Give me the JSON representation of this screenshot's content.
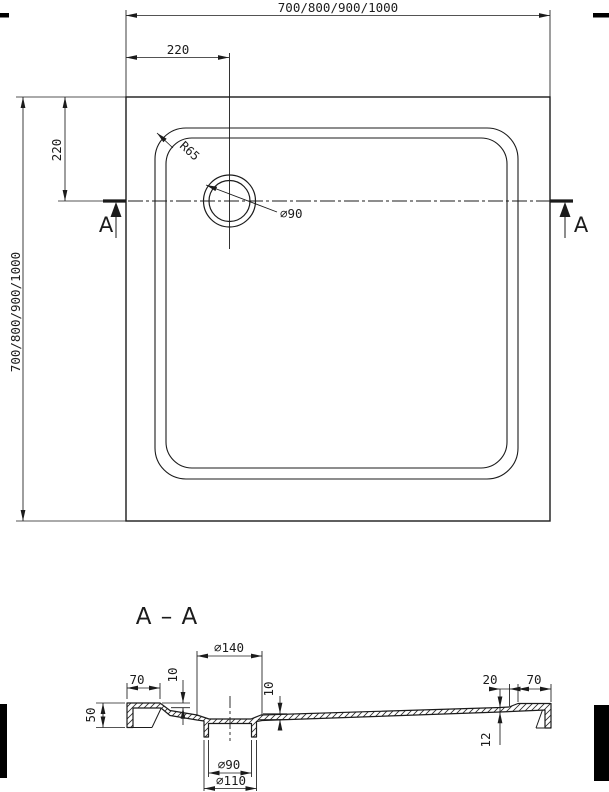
{
  "drawing": {
    "colors": {
      "line": "#1b1b1b",
      "background": "#ffffff"
    },
    "top_view": {
      "dim_width": "700/800/900/1000",
      "dim_height": "700/800/900/1000",
      "dim_drain_offset_x": "220",
      "dim_drain_offset_y": "220",
      "corner_radius_label": "R65",
      "drain_diameter_label": "⌀90",
      "section_marker_left": "A",
      "section_marker_right": "A"
    },
    "section_view": {
      "title": "A – A",
      "dim_recess_diameter": "⌀140",
      "dim_rim_width_left": "70",
      "dim_depth_left": "10",
      "dim_depth_right": "10",
      "dim_edge_height": "50",
      "dim_drain_hole_diameter": "⌀90",
      "dim_drain_spigot_diameter": "⌀110",
      "dim_edge_offset_right": "20",
      "dim_rim_width_right": "70",
      "dim_floor_thickness": "12"
    }
  }
}
